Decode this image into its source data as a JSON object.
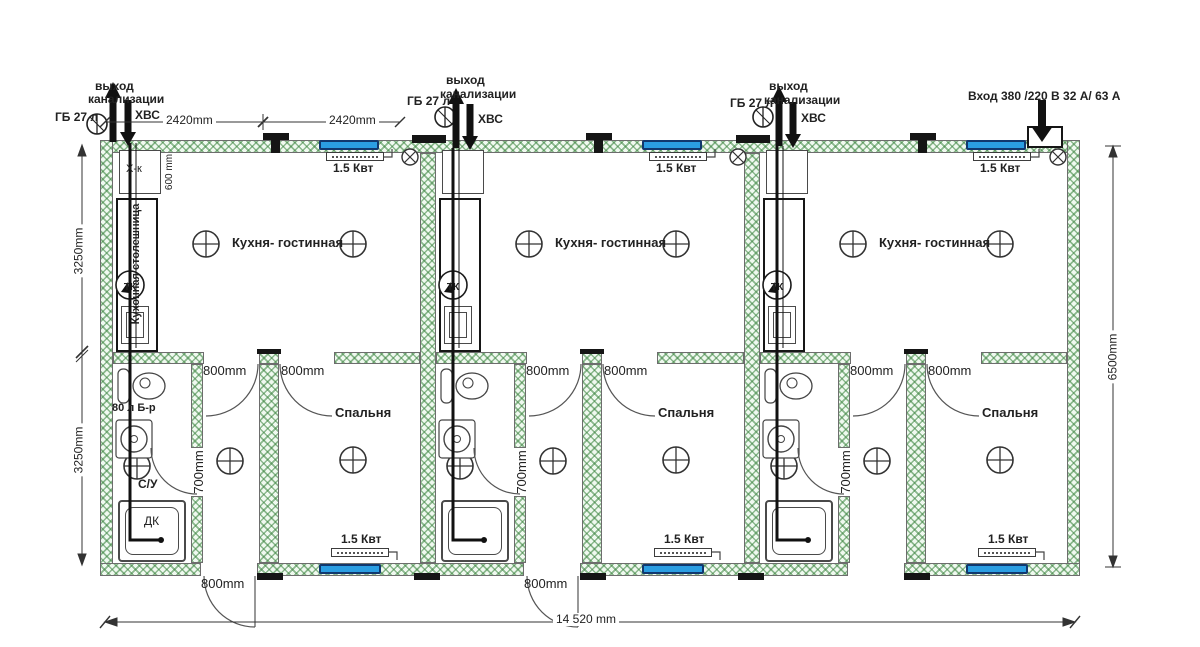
{
  "plan": {
    "utilities": {
      "sewer_exit_line1": "выход",
      "sewer_exit_line2": "канализации",
      "gas_bottle": "ГБ 27 л",
      "cold_water": "ХВС",
      "power_input": "Вход 380 /220 В  32 А/ 63 А"
    },
    "rooms": {
      "kitchen_living": "Кухня- гостинная",
      "bedroom": "Спальня",
      "bathroom": "С/У",
      "shower_cabin": "ДК"
    },
    "fixtures": {
      "fridge": "Х-к",
      "countertop": "Кухонная столешница",
      "boiler_80l": "80 л Б-р",
      "gas_boiler": "ТК",
      "heater_power": "1.5 Квт"
    },
    "dimensions": {
      "overall_width": "14 520 mm",
      "overall_depth": "6500mm",
      "bay_width": "2420mm",
      "kitchen_depth": "3250mm",
      "bedroom_depth": "3250mm",
      "interior_door_width": "800mm",
      "bathroom_door_width": "700mm",
      "fridge_niche": "600 mm"
    }
  }
}
